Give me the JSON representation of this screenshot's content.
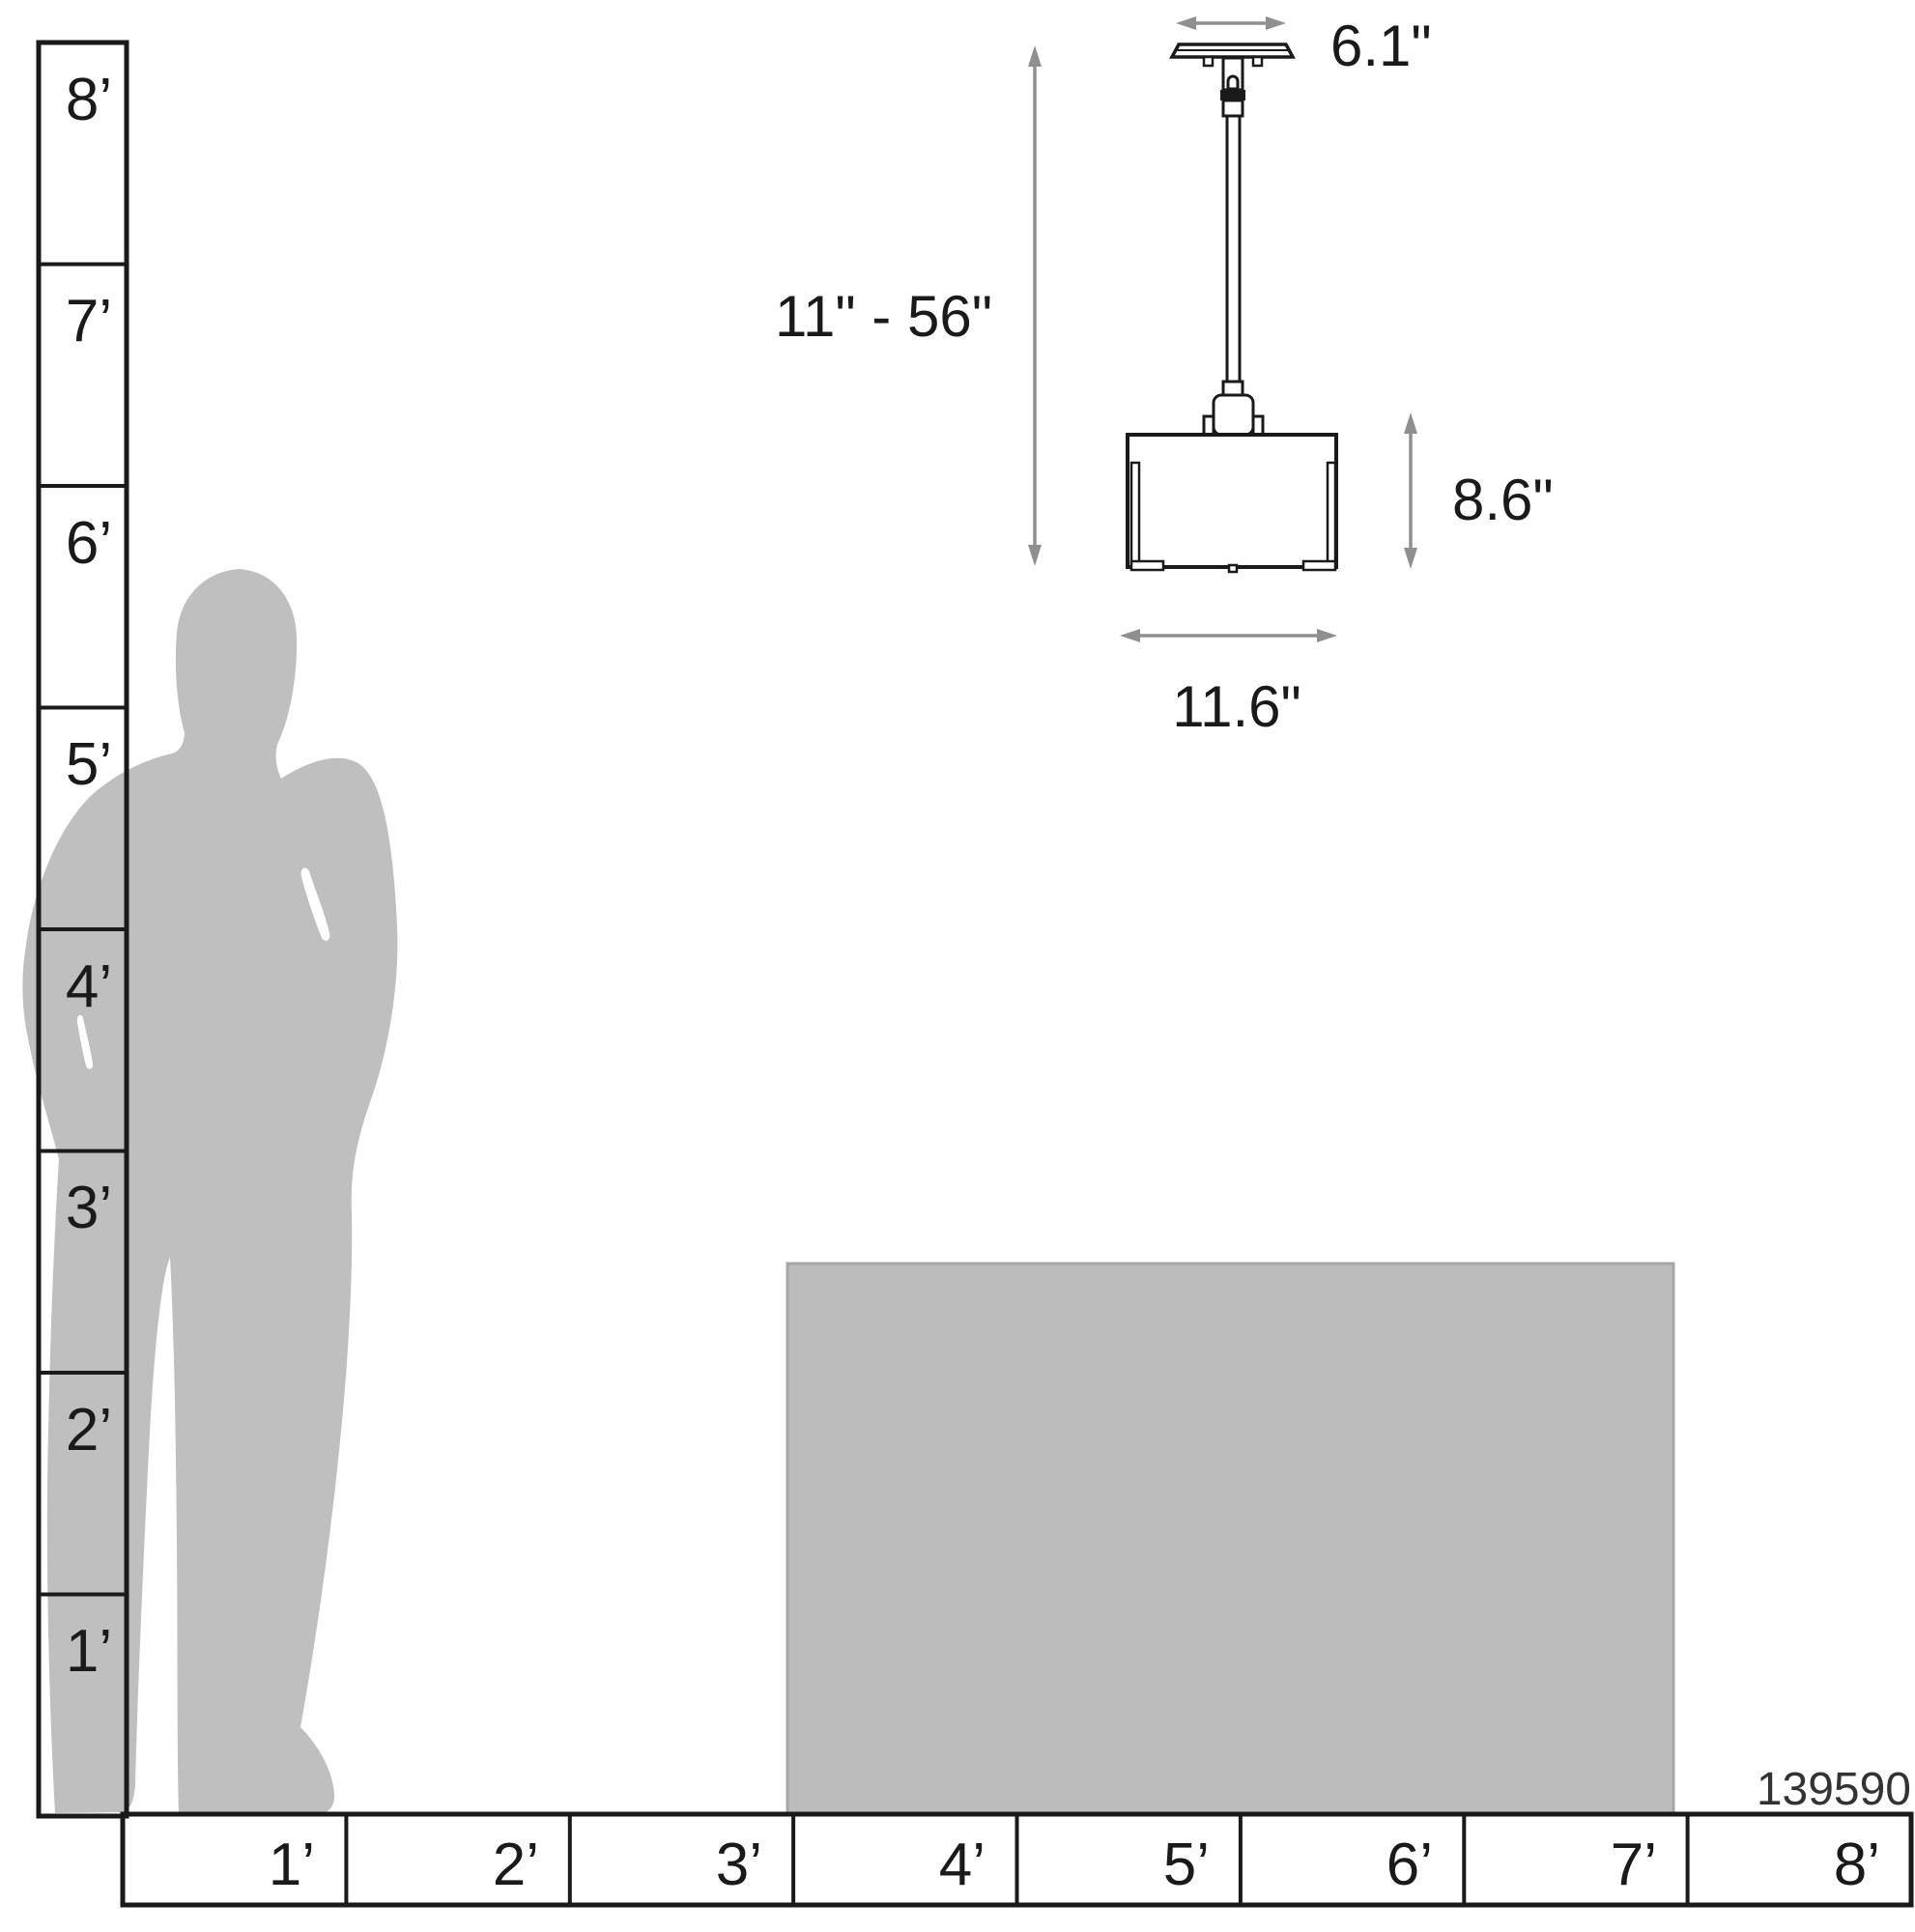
{
  "product_number": "139590",
  "vertical_ruler": {
    "labels": [
      "8’",
      "7’",
      "6’",
      "5’",
      "4’",
      "3’",
      "2’",
      "1’"
    ]
  },
  "horizontal_ruler": {
    "labels": [
      "1’",
      "2’",
      "3’",
      "4’",
      "5’",
      "6’",
      "7’",
      "8’"
    ]
  },
  "fixture_dimensions": {
    "canopy_width": "6.1\"",
    "hanging_height_range": "11\" - 56\"",
    "shade_height": "8.6\"",
    "shade_width": "11.6\""
  },
  "colors": {
    "line": "#1a1a1a",
    "text": "#1a1a1a",
    "silhouette": "#bfbfbf",
    "table": "#bcbcbc",
    "table_border": "#a6a6a6",
    "arrow": "#8f8f8f"
  }
}
